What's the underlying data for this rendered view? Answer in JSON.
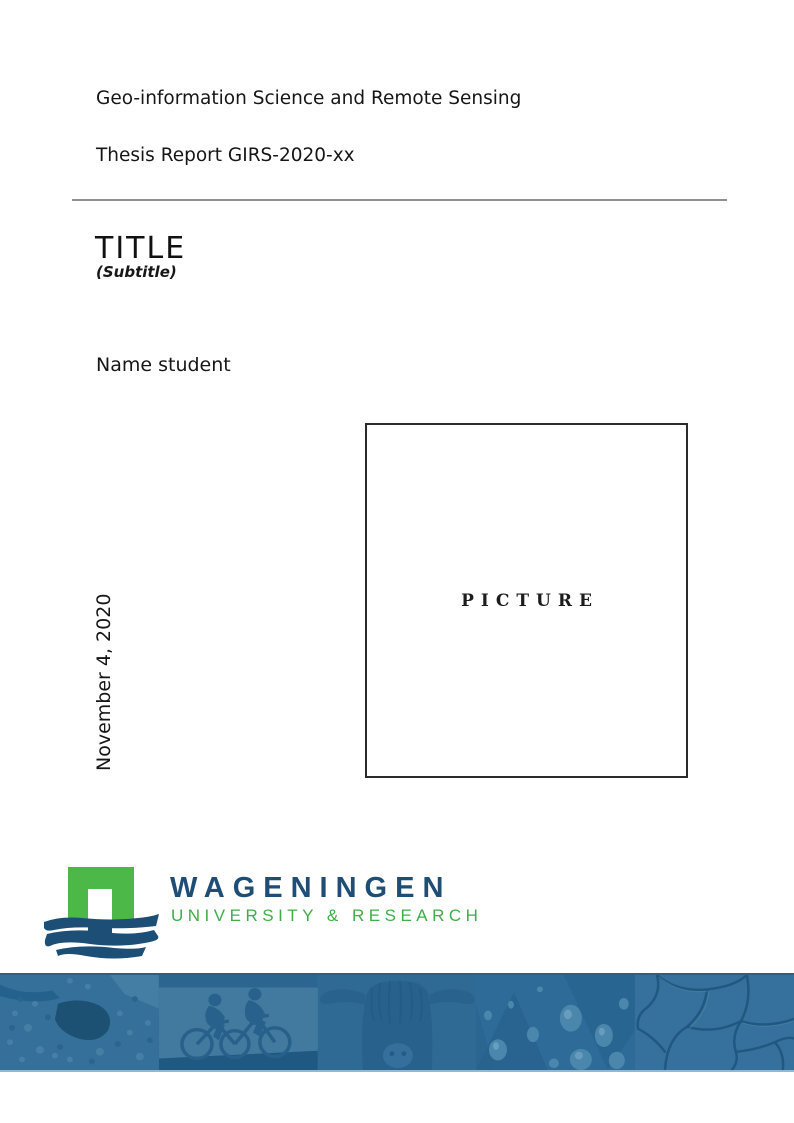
{
  "header": {
    "program": "Geo-information Science and Remote Sensing",
    "report_number": "Thesis Report GIRS-2020-xx"
  },
  "titleblock": {
    "title": "TITLE",
    "subtitle": "(Subtitle)",
    "author": "Name student",
    "date": "November 4, 2020"
  },
  "picture": {
    "placeholder": "PICTURE"
  },
  "logo": {
    "name": "WAGENINGEN",
    "tagline": "UNIVERSITY & RESEARCH",
    "brand_green": "#4cb848",
    "brand_blue": "#1e4d75",
    "mark_icon": "wageningen-arch-logo"
  },
  "banner": {
    "tint_color": "#2f6b97",
    "photos": [
      {
        "icon": "aerial-map-photo"
      },
      {
        "icon": "cyclists-photo"
      },
      {
        "icon": "highland-cow-photo"
      },
      {
        "icon": "water-droplets-photo"
      },
      {
        "icon": "cracked-earth-photo"
      }
    ]
  }
}
